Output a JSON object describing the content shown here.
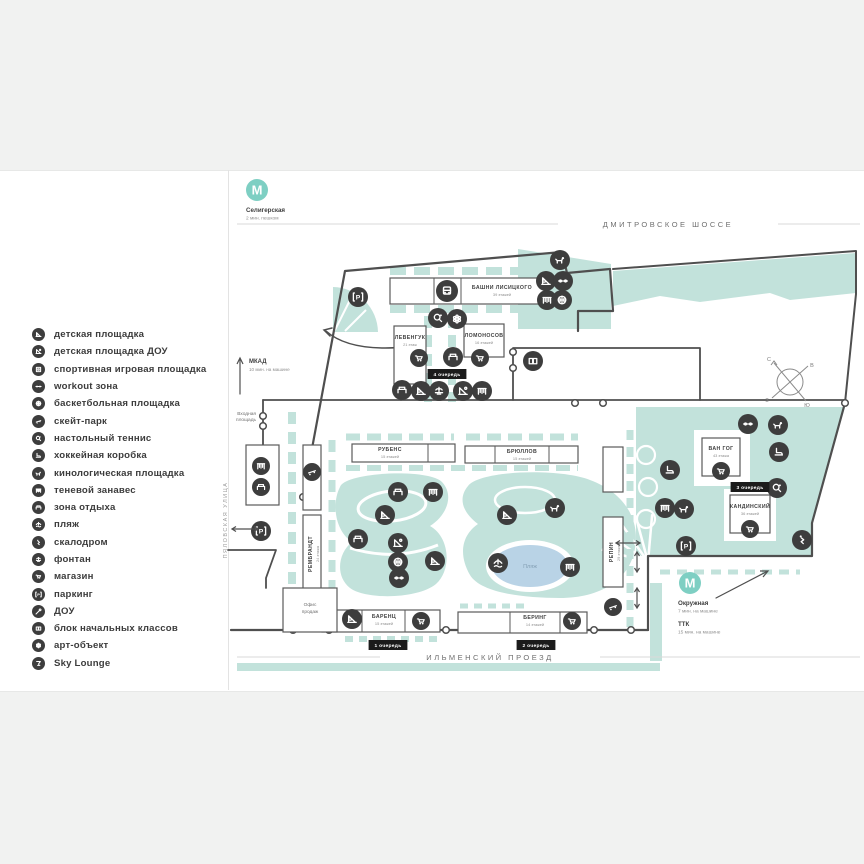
{
  "colors": {
    "teal": "#7ecfc3",
    "teal_light": "#c2e2db",
    "dark": "#3d3d3d",
    "outline": "#4f4f4f",
    "pond": "#b9d3e6",
    "pond_text": "#85a0b5",
    "bg": "#f1f2f1",
    "road_line": "#d9d9d9",
    "text": "#3f3f3f",
    "text_soft": "#8f8f8f",
    "road_text": "#6f6f6f",
    "badge": "#1b1b1b"
  },
  "legend": {
    "items": [
      {
        "icon": "playground",
        "label": "детская площадка"
      },
      {
        "icon": "playground-dou",
        "label": "детская площадка ДОУ"
      },
      {
        "icon": "sport-court",
        "label": "спортивная игровая площадка"
      },
      {
        "icon": "workout",
        "label": "workout зона"
      },
      {
        "icon": "basketball",
        "label": "баскетбольная площадка"
      },
      {
        "icon": "skate-park",
        "label": "скейт-парк"
      },
      {
        "icon": "table-tennis",
        "label": "настольный теннис"
      },
      {
        "icon": "hockey",
        "label": "хоккейная коробка"
      },
      {
        "icon": "dog-area",
        "label": "кинологическая площадка"
      },
      {
        "icon": "shade",
        "label": "теневой занавес"
      },
      {
        "icon": "rest",
        "label": "зона отдыха"
      },
      {
        "icon": "beach",
        "label": "пляж"
      },
      {
        "icon": "climbing",
        "label": "скалодром"
      },
      {
        "icon": "fountain",
        "label": "фонтан"
      },
      {
        "icon": "shop",
        "label": "магазин"
      },
      {
        "icon": "parking",
        "label": "паркинг"
      },
      {
        "icon": "dou",
        "label": "ДОУ"
      },
      {
        "icon": "school",
        "label": "блок начальных классов"
      },
      {
        "icon": "art",
        "label": "арт-объект"
      },
      {
        "icon": "sky-lounge",
        "label": "Sky Lounge"
      }
    ]
  },
  "map": {
    "roads": [
      {
        "id": "dmitrovskoe",
        "label": "ДМИТРОВСКОЕ ШОССЕ",
        "x": 668,
        "y": 227,
        "line_y": 224,
        "x1": 237,
        "x2": 860
      },
      {
        "id": "ilmensky",
        "label": "ИЛЬМЕНСКИЙ ПРОЕЗД",
        "x": 490,
        "y": 660,
        "line_y": 657,
        "x1": 237,
        "x2": 860
      },
      {
        "id": "pyalovskaya",
        "label": "ПЯЛОВСКАЯ УЛИЦА",
        "x": 227,
        "y": 520,
        "vertical": true
      }
    ],
    "metro": [
      {
        "label": "Селигерская",
        "sub": "2 мин. пешком",
        "cx": 257,
        "cy": 190,
        "tx": 246,
        "ty": 212
      },
      {
        "label": "Окружная",
        "sub": "7 мин. на машине",
        "cx": 690,
        "cy": 583,
        "tx": 678,
        "ty": 605
      }
    ],
    "ttk": {
      "label": "ТТК",
      "sub": "15 мин. на машине",
      "x": 678,
      "y": 626
    },
    "mkad": {
      "label": "МКАД",
      "sub": "10 мин. на машине",
      "x": 249,
      "y": 363
    },
    "entry": {
      "line1": "Входная",
      "line2": "площадь",
      "x": 256,
      "y": 415
    },
    "office": {
      "line1": "Офис",
      "line2": "продаж",
      "x": 310,
      "y": 606
    },
    "pond": {
      "label": "Пляж",
      "x": 530,
      "y": 568
    },
    "compass": {
      "n": "С",
      "e": "В",
      "w": "З",
      "s": "Ю",
      "cx": 790,
      "cy": 382
    },
    "metro_letter": "М",
    "phases": [
      {
        "label": "4 очередь",
        "x": 447,
        "y": 374
      },
      {
        "label": "1 очередь",
        "x": 388,
        "y": 645
      },
      {
        "label": "2 очередь",
        "x": 536,
        "y": 645
      },
      {
        "label": "3 очередь",
        "x": 750,
        "y": 487
      }
    ],
    "buildings": [
      {
        "id": "lisitsky",
        "name": "БАШНИ ЛИСИЦКОГО",
        "floors": "39 этажей",
        "x": 390,
        "y": 278,
        "w": 155,
        "h": 26,
        "lx": 502,
        "ly": 289,
        "dividers": [
          434,
          461
        ]
      },
      {
        "id": "levenguk",
        "name": "ЛЕВЕНГУК",
        "floors": "21 этаж",
        "x": 394,
        "y": 326,
        "w": 32,
        "h": 58,
        "lx": 410,
        "ly": 339
      },
      {
        "id": "lomonosov",
        "name": "ЛОМОНОСОВ",
        "floors": "16 этажей",
        "x": 464,
        "y": 324,
        "w": 40,
        "h": 33,
        "lx": 484,
        "ly": 337
      },
      {
        "id": "rubens",
        "name": "РУБЕНС",
        "floors": "15 этажей",
        "x": 352,
        "y": 444,
        "w": 103,
        "h": 18,
        "lx": 390,
        "ly": 451,
        "dividers": [
          428
        ]
      },
      {
        "id": "bryullov",
        "name": "БРЮЛЛОВ",
        "floors": "15 этажей",
        "x": 465,
        "y": 446,
        "w": 113,
        "h": 17,
        "lx": 522,
        "ly": 453,
        "dividers": [
          495,
          549
        ]
      },
      {
        "id": "barents",
        "name": "БАРЕНЦ",
        "floors": "15 этажей",
        "x": 322,
        "y": 610,
        "w": 118,
        "h": 22,
        "lx": 384,
        "ly": 618,
        "dividers": [
          362,
          405
        ]
      },
      {
        "id": "bering",
        "name": "БЕРИНГ",
        "floors": "14 этажей",
        "x": 458,
        "y": 612,
        "w": 129,
        "h": 21,
        "lx": 535,
        "ly": 619,
        "dividers": [
          510,
          560
        ]
      },
      {
        "id": "vangogh",
        "name": "ВАН ГОГ",
        "floors": "43 этажа",
        "x": 702,
        "y": 438,
        "w": 38,
        "h": 38,
        "lx": 721,
        "ly": 450
      },
      {
        "id": "kandinsky",
        "name": "КАНДИНСКИЙ",
        "floors": "36 этажей",
        "x": 730,
        "y": 495,
        "w": 40,
        "h": 38,
        "lx": 750,
        "ly": 508
      },
      {
        "id": "rembrandt",
        "name": "РЕМБРАНДТ",
        "floors": "24 этажа",
        "x": 303,
        "y": 515,
        "w": 18,
        "h": 78,
        "vertical": true,
        "lx": 312,
        "ly": 554
      },
      {
        "id": "repin",
        "name": "РЕПИН",
        "floors": "29 этажей",
        "x": 603,
        "y": 517,
        "w": 20,
        "h": 70,
        "vertical": true,
        "lx": 613,
        "ly": 552
      }
    ],
    "plain_boxes": [
      {
        "x": 303,
        "y": 445,
        "w": 18,
        "h": 65
      },
      {
        "x": 603,
        "y": 447,
        "w": 20,
        "h": 45
      },
      {
        "x": 246,
        "y": 445,
        "w": 33,
        "h": 60
      },
      {
        "x": 283,
        "y": 588,
        "w": 54,
        "h": 44
      }
    ],
    "icons": [
      {
        "t": "dog-area",
        "x": 560,
        "y": 260
      },
      {
        "t": "playground",
        "x": 546,
        "y": 281
      },
      {
        "t": "workout",
        "x": 563,
        "y": 281
      },
      {
        "t": "shade",
        "x": 547,
        "y": 300
      },
      {
        "t": "basketball",
        "x": 562,
        "y": 300
      },
      {
        "t": "parking",
        "x": 358,
        "y": 297
      },
      {
        "t": "table-tennis",
        "x": 438,
        "y": 318
      },
      {
        "t": "art",
        "x": 457,
        "y": 319
      },
      {
        "t": "shop",
        "x": 419,
        "y": 358,
        "r": 9
      },
      {
        "t": "rest",
        "x": 453,
        "y": 357
      },
      {
        "t": "shop",
        "x": 480,
        "y": 358,
        "r": 9
      },
      {
        "t": "rest",
        "x": 402,
        "y": 390
      },
      {
        "t": "playground",
        "x": 421,
        "y": 391
      },
      {
        "t": "fountain",
        "x": 439,
        "y": 391
      },
      {
        "t": "playground-dou",
        "x": 463,
        "y": 391
      },
      {
        "t": "shade",
        "x": 482,
        "y": 391
      },
      {
        "t": "school",
        "x": 533,
        "y": 361
      },
      {
        "t": "bus",
        "x": 447,
        "y": 291,
        "r": 11
      },
      {
        "t": "shade",
        "x": 261,
        "y": 466,
        "r": 9
      },
      {
        "t": "rest",
        "x": 261,
        "y": 487,
        "r": 9
      },
      {
        "t": "parking",
        "x": 261,
        "y": 531
      },
      {
        "t": "skate-park",
        "x": 312,
        "y": 472,
        "r": 9
      },
      {
        "t": "playground",
        "x": 352,
        "y": 619
      },
      {
        "t": "rest",
        "x": 398,
        "y": 492
      },
      {
        "t": "shade",
        "x": 433,
        "y": 492
      },
      {
        "t": "playground",
        "x": 385,
        "y": 515
      },
      {
        "t": "rest",
        "x": 358,
        "y": 539
      },
      {
        "t": "playground-dou",
        "x": 398,
        "y": 543
      },
      {
        "t": "basketball",
        "x": 398,
        "y": 562
      },
      {
        "t": "playground",
        "x": 435,
        "y": 561
      },
      {
        "t": "workout",
        "x": 399,
        "y": 578
      },
      {
        "t": "playground",
        "x": 507,
        "y": 515
      },
      {
        "t": "dog-area",
        "x": 555,
        "y": 508
      },
      {
        "t": "beach",
        "x": 498,
        "y": 563
      },
      {
        "t": "shade",
        "x": 570,
        "y": 567
      },
      {
        "t": "shop",
        "x": 421,
        "y": 621,
        "r": 9
      },
      {
        "t": "shop",
        "x": 572,
        "y": 621,
        "r": 9
      },
      {
        "t": "skate-park",
        "x": 613,
        "y": 607,
        "r": 9
      },
      {
        "t": "hockey",
        "x": 670,
        "y": 470
      },
      {
        "t": "shade",
        "x": 665,
        "y": 508
      },
      {
        "t": "dog-area",
        "x": 684,
        "y": 509
      },
      {
        "t": "parking",
        "x": 686,
        "y": 546
      },
      {
        "t": "workout",
        "x": 748,
        "y": 424
      },
      {
        "t": "dog-area",
        "x": 778,
        "y": 425
      },
      {
        "t": "hockey",
        "x": 779,
        "y": 452
      },
      {
        "t": "table-tennis",
        "x": 777,
        "y": 488
      },
      {
        "t": "climbing",
        "x": 802,
        "y": 540
      },
      {
        "t": "shop",
        "x": 721,
        "y": 471,
        "r": 9
      },
      {
        "t": "shop",
        "x": 750,
        "y": 529,
        "r": 9
      }
    ]
  }
}
